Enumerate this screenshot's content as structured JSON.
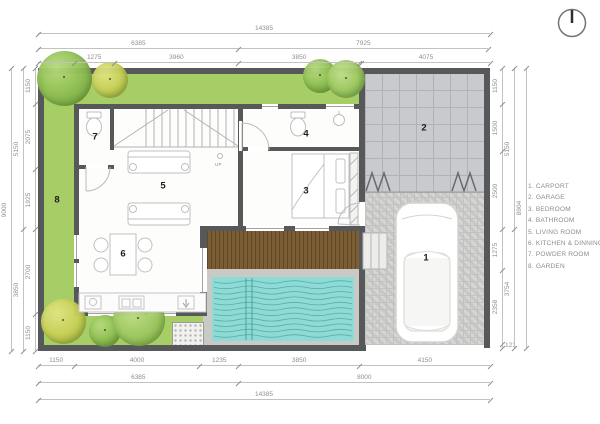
{
  "legend": {
    "items": [
      {
        "text": "1. CARPORT"
      },
      {
        "text": "2. GARAGE"
      },
      {
        "text": "3. BEDROOM"
      },
      {
        "text": "4. BATHROOM"
      },
      {
        "text": "5. LIVING ROOM"
      },
      {
        "text": "6. KITCHEN & DINNING"
      },
      {
        "text": "7. POWDER ROOM"
      },
      {
        "text": "8. GARDEN"
      }
    ]
  },
  "rooms": {
    "carport": "1",
    "garage": "2",
    "bedroom": "3",
    "bathroom": "4",
    "living_room": "5",
    "kitchen_dining": "6",
    "powder_room": "7",
    "garden": "8"
  },
  "stairs": {
    "up_label": "UP"
  },
  "dimensions": {
    "top_outer": [
      {
        "label": "14385",
        "mm": 14385
      }
    ],
    "top_mid": [
      {
        "label": "6385",
        "mm": 6385
      },
      {
        "label": "7925",
        "mm": 7925
      }
    ],
    "top_inner": [
      {
        "label": "",
        "mm": 1150
      },
      {
        "label": "1275",
        "mm": 1275
      },
      {
        "label": "3960",
        "mm": 3960
      },
      {
        "label": "3850",
        "mm": 3850
      },
      {
        "label": "",
        "mm": 75
      },
      {
        "label": "4075",
        "mm": 4075
      }
    ],
    "bottom_inner": [
      {
        "label": "1150",
        "mm": 1150
      },
      {
        "label": "4000",
        "mm": 4000
      },
      {
        "label": "1235",
        "mm": 1235
      },
      {
        "label": "3850",
        "mm": 3850
      },
      {
        "label": "4150",
        "mm": 4150
      }
    ],
    "bottom_mid": [
      {
        "label": "6385",
        "mm": 6385
      },
      {
        "label": "8000",
        "mm": 8000
      }
    ],
    "bottom_outer": [
      {
        "label": "14385",
        "mm": 14385
      }
    ],
    "left_inner": [
      {
        "label": "1150",
        "mm": 1150
      },
      {
        "label": "2075",
        "mm": 2075
      },
      {
        "label": "1925",
        "mm": 1925
      },
      {
        "label": "2700",
        "mm": 2700
      },
      {
        "label": "1150",
        "mm": 1150
      }
    ],
    "left_mid": [
      {
        "label": "5150",
        "mm": 5150
      },
      {
        "label": "3850",
        "mm": 3850
      }
    ],
    "left_outer": [
      {
        "label": "9000",
        "mm": 9000
      }
    ],
    "right_inner": [
      {
        "label": "1150",
        "mm": 1150
      },
      {
        "label": "1500",
        "mm": 1500
      },
      {
        "label": "2500",
        "mm": 2500
      },
      {
        "label": "1275",
        "mm": 1275
      },
      {
        "label": "2358",
        "mm": 2358
      },
      {
        "label": "121",
        "mm": 121,
        "flat": true
      }
    ],
    "right_mid": [
      {
        "label": "5150",
        "mm": 5150
      },
      {
        "label": "3754",
        "mm": 3754
      }
    ],
    "right_outer": [
      {
        "label": "8904",
        "mm": 8904
      }
    ]
  },
  "colors": {
    "garden_green": "#a7cd66",
    "wall": "#57585a",
    "pool_water": "#8edad5",
    "deck_brown": "#7c5e35",
    "garage_floor": "#c9cacd",
    "carport_floor": "#d4d4d2",
    "dimension_text": "#8f8f8f",
    "legend_text": "#8c8c8c",
    "room_label": "#1c1c1c"
  }
}
